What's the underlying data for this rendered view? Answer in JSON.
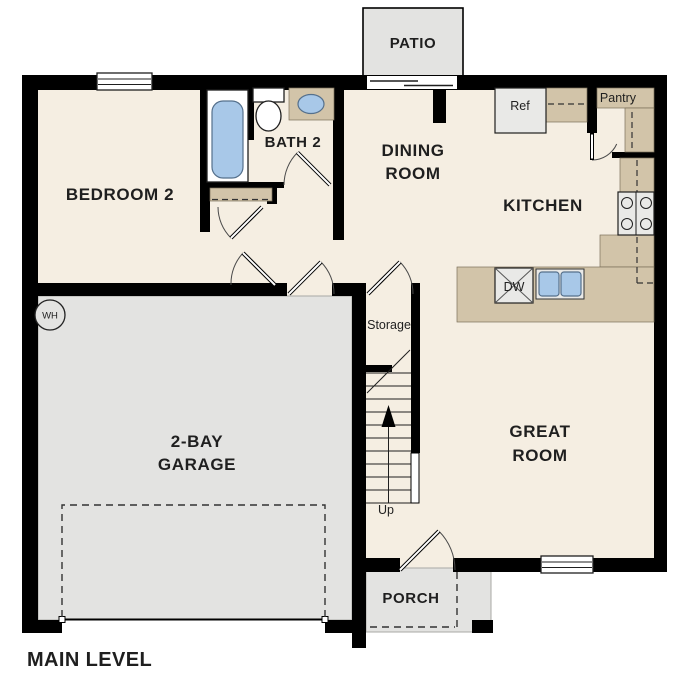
{
  "title": "MAIN LEVEL",
  "palette": {
    "floor": "#f5eee2",
    "slab": "#e3e3e1",
    "counter": "#d2c4a9",
    "water": "#a8c8e8",
    "appliance": "#e9e9e7",
    "wall": "#000000",
    "ink": "#1f1f1f",
    "line": "#333333"
  },
  "rooms": {
    "bedroom2": {
      "label": "BEDROOM 2"
    },
    "bath2": {
      "label": "BATH 2"
    },
    "dining": {
      "lines": [
        "DINING",
        "ROOM"
      ]
    },
    "kitchen": {
      "label": "KITCHEN"
    },
    "great_room": {
      "lines": [
        "GREAT",
        "ROOM"
      ]
    },
    "garage": {
      "lines": [
        "2-BAY",
        "GARAGE"
      ]
    },
    "storage": {
      "label": "Storage"
    },
    "pantry": {
      "label": "Pantry"
    },
    "patio": {
      "label": "PATIO"
    },
    "porch": {
      "label": "PORCH"
    }
  },
  "fixtures": {
    "refrigerator": {
      "label": "Ref"
    },
    "dishwasher": {
      "label": "DW"
    },
    "water_heater": {
      "label": "WH"
    },
    "stairs": {
      "label": "Up"
    }
  }
}
